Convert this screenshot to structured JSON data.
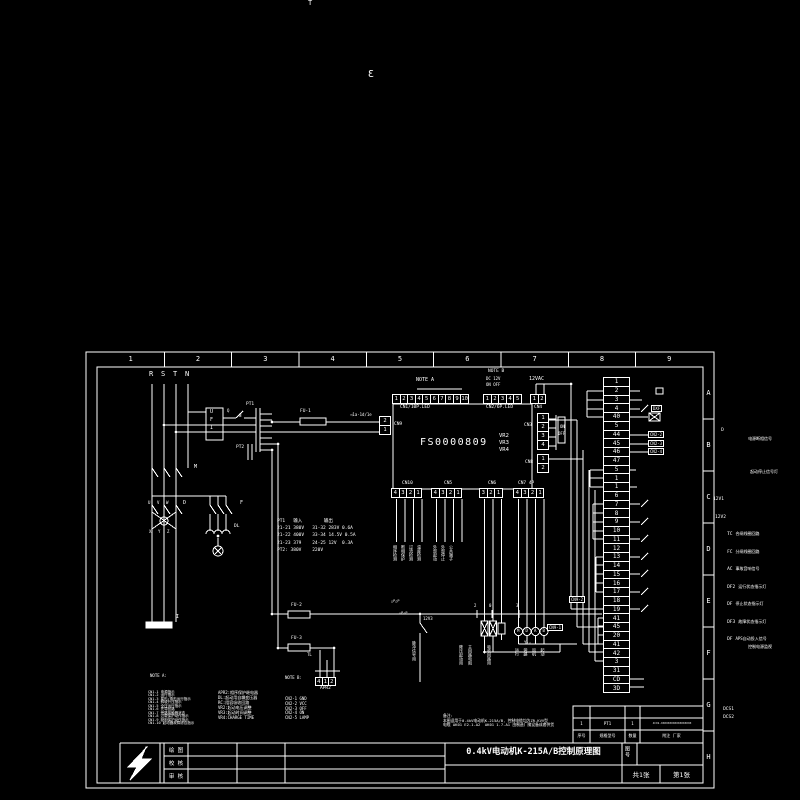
{
  "frame": {
    "zone_numbers": [
      "1",
      "2",
      "3",
      "4",
      "5",
      "6",
      "7",
      "8",
      "9"
    ],
    "zone_letters": [
      "A",
      "B",
      "C",
      "D",
      "E",
      "F",
      "G",
      "H"
    ]
  },
  "board": {
    "title": "FS0000809"
  },
  "connectors": {
    "cn1": [
      "1",
      "2",
      "3",
      "4",
      "5",
      "6",
      "7",
      "8",
      "9",
      "10"
    ],
    "cn2": [
      "1",
      "2",
      "3",
      "4",
      "5"
    ],
    "cn4": [
      "1",
      "2"
    ],
    "cn3": [
      "1",
      "2",
      "3",
      "4"
    ],
    "cn8": [
      "1",
      "2"
    ],
    "cn9": [
      "2",
      "1"
    ],
    "cn10": [
      "4",
      "3",
      "2",
      "1"
    ],
    "cn5": [
      "4",
      "3",
      "2",
      "1"
    ],
    "cn6": [
      "3",
      "2",
      "1"
    ],
    "cn7": [
      "4",
      "3",
      "2",
      "1"
    ],
    "apr2": [
      "4",
      "1",
      "2"
    ]
  },
  "terminal_strip": {
    "rows": [
      "1",
      "2",
      "3",
      "4",
      "40",
      "5",
      "44",
      "45",
      "46",
      "47",
      "5",
      "1",
      "1",
      "6",
      "7",
      "8",
      "9",
      "10",
      "11",
      "12",
      "13",
      "14",
      "15",
      "16",
      "17",
      "18",
      "19",
      "41",
      "45",
      "20",
      "41",
      "42",
      "3",
      "31",
      "CD",
      "3D"
    ]
  },
  "labels": [
    {
      "t": "T",
      "x": 308,
      "y": 0,
      "fs": 7
    },
    {
      "t": "Ɛ",
      "x": 368,
      "y": 70,
      "fs": 10
    },
    {
      "t": "R",
      "x": 149,
      "y": 371,
      "fs": 7
    },
    {
      "t": "S",
      "x": 161,
      "y": 371,
      "fs": 7
    },
    {
      "t": "T",
      "x": 173,
      "y": 371,
      "fs": 7
    },
    {
      "t": "N",
      "x": 185,
      "y": 371,
      "fs": 7
    },
    {
      "t": "U",
      "x": 210,
      "y": 410,
      "fs": 5
    },
    {
      "t": "F",
      "x": 210,
      "y": 418,
      "fs": 5
    },
    {
      "t": "I",
      "x": 210,
      "y": 426,
      "fs": 5
    },
    {
      "t": "Q",
      "x": 227,
      "y": 409,
      "fs": 4
    },
    {
      "t": "N",
      "x": 239,
      "y": 414,
      "fs": 4
    },
    {
      "t": "PT1",
      "x": 246,
      "y": 403,
      "fs": 4.5
    },
    {
      "t": "FU-1",
      "x": 300,
      "y": 410,
      "fs": 4.5
    },
    {
      "t": "◁1a·1d/1e",
      "x": 350,
      "y": 413,
      "fs": 4
    },
    {
      "t": "PT2",
      "x": 236,
      "y": 446,
      "fs": 4.5
    },
    {
      "t": "M",
      "x": 194,
      "y": 465,
      "fs": 5
    },
    {
      "t": "D",
      "x": 183,
      "y": 501,
      "fs": 5
    },
    {
      "t": "F",
      "x": 240,
      "y": 501,
      "fs": 5
    },
    {
      "t": "U",
      "x": 148,
      "y": 501,
      "fs": 4
    },
    {
      "t": "V",
      "x": 157,
      "y": 501,
      "fs": 4
    },
    {
      "t": "W",
      "x": 166,
      "y": 501,
      "fs": 4
    },
    {
      "t": "X",
      "x": 149,
      "y": 530,
      "fs": 4
    },
    {
      "t": "Y",
      "x": 158,
      "y": 530,
      "fs": 4
    },
    {
      "t": "Z",
      "x": 167,
      "y": 530,
      "fs": 4
    },
    {
      "t": "DL",
      "x": 234,
      "y": 525,
      "fs": 4.5
    },
    {
      "t": "I",
      "x": 176,
      "y": 615,
      "fs": 5
    },
    {
      "t": "FU-2",
      "x": 291,
      "y": 604,
      "fs": 4.5
    },
    {
      "t": "FU-3",
      "x": 291,
      "y": 637,
      "fs": 4.5
    },
    {
      "t": "TL",
      "x": 307,
      "y": 653,
      "fs": 4
    },
    {
      "t": "12V3",
      "x": 423,
      "y": 617,
      "fs": 4
    },
    {
      "t": "2",
      "x": 474,
      "y": 604,
      "fs": 4
    },
    {
      "t": "0",
      "x": 489,
      "y": 604,
      "fs": 4
    },
    {
      "t": "3",
      "x": 516,
      "y": 604,
      "fs": 4
    },
    {
      "t": "Y-△",
      "x": 524,
      "y": 641,
      "fs": 4
    },
    {
      "t": "M",
      "x": 517,
      "y": 629,
      "fs": 4
    },
    {
      "t": "D",
      "x": 525.5,
      "y": 629,
      "fs": 4
    },
    {
      "t": "A",
      "x": 534,
      "y": 629,
      "fs": 4
    },
    {
      "t": "B",
      "x": 542.5,
      "y": 629,
      "fs": 4
    },
    {
      "t": "NOTE A",
      "x": 416,
      "y": 378,
      "fs": 5
    },
    {
      "t": "NOTE B",
      "x": 488,
      "y": 370,
      "fs": 4.5
    },
    {
      "t": "DC 12V",
      "x": 486,
      "y": 377,
      "fs": 4
    },
    {
      "t": "ON OFF",
      "x": 486,
      "y": 383,
      "fs": 4
    },
    {
      "t": "12VAC",
      "x": 529,
      "y": 377,
      "fs": 5
    },
    {
      "t": "ON",
      "x": 560,
      "y": 425,
      "fs": 4
    },
    {
      "t": "OFF",
      "x": 558,
      "y": 432,
      "fs": 4
    },
    {
      "t": "VR2",
      "x": 499,
      "y": 434,
      "fs": 5.5
    },
    {
      "t": "VR3",
      "x": 499,
      "y": 441,
      "fs": 5.5
    },
    {
      "t": "VR4",
      "x": 499,
      "y": 448,
      "fs": 5.5
    },
    {
      "t": "CN1/10P.LED",
      "x": 400,
      "y": 406,
      "fs": 4.5
    },
    {
      "t": "CN2/6P.LED",
      "x": 486,
      "y": 406,
      "fs": 4.5
    },
    {
      "t": "CN4",
      "x": 534,
      "y": 406,
      "fs": 4.5
    },
    {
      "t": "CN3",
      "x": 524,
      "y": 424,
      "fs": 4.5
    },
    {
      "t": "CN8",
      "x": 525,
      "y": 461,
      "fs": 4.5
    },
    {
      "t": "CN9",
      "x": 394,
      "y": 423,
      "fs": 4.5
    },
    {
      "t": "CN10",
      "x": 402,
      "y": 482,
      "fs": 4.5
    },
    {
      "t": "CN5",
      "x": 444,
      "y": 482,
      "fs": 4.5
    },
    {
      "t": "CN6",
      "x": 488,
      "y": 482,
      "fs": 4.5
    },
    {
      "t": "CN7 4P",
      "x": 518,
      "y": 482,
      "fs": 4.5
    },
    {
      "t": "APR2",
      "x": 320,
      "y": 687,
      "fs": 4.5
    },
    {
      "t": "NOTE A:",
      "x": 150,
      "y": 674,
      "fs": 4
    },
    {
      "t": "NOTE B:",
      "x": 285,
      "y": 676,
      "fs": 4
    },
    {
      "t": "△P△P",
      "x": 391,
      "y": 600,
      "fs": 3.5
    },
    {
      "t": "△P△P",
      "x": 399,
      "y": 612,
      "fs": 3.5
    }
  ],
  "vlabels": [
    {
      "t": "相序检测",
      "x": 393,
      "y": 545
    },
    {
      "t": "断相保护",
      "x": 401,
      "y": 545
    },
    {
      "t": "过流检测",
      "x": 409,
      "y": 545
    },
    {
      "t": "温度检测",
      "x": 417,
      "y": 545
    },
    {
      "t": "外部起动",
      "x": 433,
      "y": 545
    },
    {
      "t": "外部停止",
      "x": 441,
      "y": 545
    },
    {
      "t": "公共端子",
      "x": 449,
      "y": 545
    },
    {
      "t": "脉冲信号用",
      "x": 412,
      "y": 641
    },
    {
      "t": "降压起动用",
      "x": 459,
      "y": 645
    },
    {
      "t": "主回路电阻",
      "x": 468,
      "y": 645
    },
    {
      "t": "吸收回路用",
      "x": 487,
      "y": 645
    },
    {
      "t": "运行",
      "x": 515,
      "y": 648
    },
    {
      "t": "旁路",
      "x": 523.5,
      "y": 648
    },
    {
      "t": "风机",
      "x": 532,
      "y": 648
    },
    {
      "t": "起动",
      "x": 540.5,
      "y": 648
    }
  ],
  "boxlabels": [
    {
      "t": "DXF",
      "x": 651,
      "y": 405
    },
    {
      "t": "CN2-2",
      "x": 648,
      "y": 431
    },
    {
      "t": "CN2-3",
      "x": 648,
      "y": 440
    },
    {
      "t": "CN2-4",
      "x": 648,
      "y": 448
    },
    {
      "t": "CN9-2",
      "x": 569,
      "y": 596
    },
    {
      "t": "CN9-1",
      "x": 547,
      "y": 624
    }
  ],
  "relay_rows": [
    {
      "x": 644,
      "y": 397,
      "tag": "D",
      "desc": ""
    },
    {
      "x": 668,
      "y": 406,
      "tag": "",
      "desc": "电源断相信号"
    },
    {
      "x": 670,
      "y": 439,
      "tag": "",
      "desc": "起动停止信号灯"
    },
    {
      "x": 636,
      "y": 466,
      "tag": "12V1",
      "desc": ""
    },
    {
      "x": 638,
      "y": 484,
      "tag": "12V2",
      "desc": ""
    },
    {
      "x": 650,
      "y": 501,
      "tag": "TC",
      "desc": "合闸线圈回路"
    },
    {
      "x": 650,
      "y": 519,
      "tag": "FC",
      "desc": "分闸线圈回路"
    },
    {
      "x": 650,
      "y": 536,
      "tag": "AC",
      "desc": "事故音响信号"
    },
    {
      "x": 650,
      "y": 554,
      "tag": "DF2",
      "desc": "运行状态指示灯"
    },
    {
      "x": 650,
      "y": 571,
      "tag": "DF",
      "desc": "停止状态指示灯"
    },
    {
      "x": 650,
      "y": 589,
      "tag": "DF3",
      "desc": "故障状态指示灯"
    },
    {
      "x": 650,
      "y": 606,
      "tag": "DF",
      "desc": "APS自动投入信号"
    },
    {
      "x": 668,
      "y": 614,
      "tag": "",
      "desc": "控制电源监视"
    },
    {
      "x": 646,
      "y": 676,
      "tag": "DCS1",
      "desc": ""
    },
    {
      "x": 646,
      "y": 684,
      "tag": "DCS2",
      "desc": ""
    }
  ],
  "note_a": {
    "items": [
      "CN1-1 电源指示",
      "CN1-2 运行指示",
      "CN1-3 星形/角形运行指示",
      "CN1-4 斜坡升压指示",
      "CN1-5 全压运行指示",
      "CN1-6 先导回路",
      "CN1-7 旁路接触器状态",
      "CN1-8 过载保护动作指示",
      "CN1-9 缺相保护动作指示",
      "CN1-10 起动器故障综合指示"
    ]
  },
  "mid_notes": {
    "items": [
      "APR2:相序保护继电器",
      "DL:起动用自耦变压器",
      "RC:阻容吸收回路",
      "VR2:起动电压调整",
      "VR3:起动时间调整",
      "VR4:CHARGE TIME"
    ]
  },
  "note_b": {
    "items": [
      "CN2-1 GND",
      "CN2-2 VCC",
      "CN2-3 OFF",
      "CN2-4 ON",
      "CN2-5 LAMP"
    ]
  },
  "pt_table": {
    "lines": [
      "PT1   输入        输出",
      "21-21 380V   31-32 283V 0.6A",
      "21-22 400V   33-34 14.5V 0.5A",
      "21-23 379    24-25 12V  0.3A",
      "PT2: 380V    220V"
    ]
  },
  "remarks": {
    "lines": [
      "备注:",
      "本图适用于0.4kV电动机K-215A/B, 控制电缆均为ZR-KVV型",
      "电缆 AK01 E2.1-A2  AK01 1.7-A1 由制造厂随设备成套供货"
    ]
  },
  "title_block": {
    "rows_left": [
      "绘 图",
      "校 核",
      "审 核"
    ],
    "title": "0.4kV电动机K-215A/B控制原理图",
    "sheet_no_label": "图号",
    "total": "共1张",
    "page": "第1张",
    "parts_header": [
      "序号",
      "规格型号",
      "数量",
      "附注  厂家"
    ],
    "parts_row": [
      "1",
      "PT1",
      "1",
      "JCX1-XXXXXXXXXXXXXXXXXX"
    ]
  }
}
